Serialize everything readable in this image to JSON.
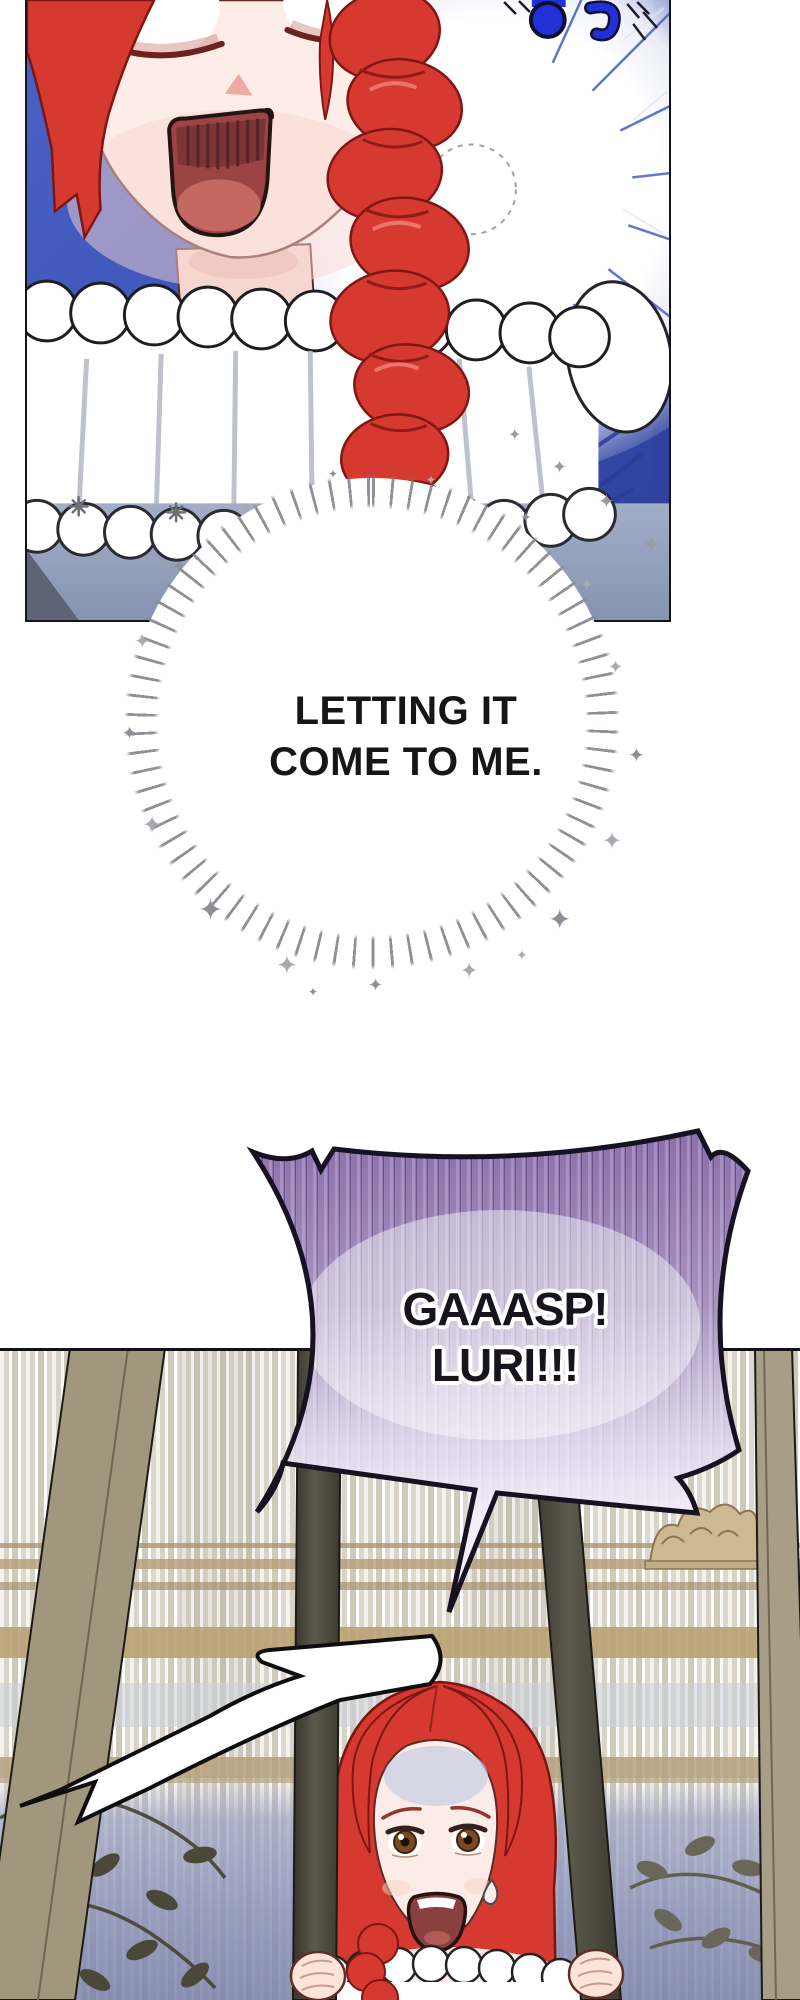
{
  "comic": {
    "thought_bubble": {
      "line1": "LETTING IT",
      "line2": "COME TO ME."
    },
    "shout_bubble": {
      "line1": "GAAASP!",
      "line2": "LURI!!!"
    },
    "surprise_marks": "!?",
    "sparkle_char": "✦"
  },
  "palette": {
    "panel_blue": "#3a51b4",
    "hair_red": "#d6392f",
    "balloon_stripe_purple": "#8b6fa9",
    "cage_bar_tan": "#a1977f",
    "cage_bar_dark": "#565247",
    "wall_violet": "#8890b8",
    "curtain_tan_band": "#b5a07a",
    "surprise_mark_blue": "#2230d8"
  }
}
